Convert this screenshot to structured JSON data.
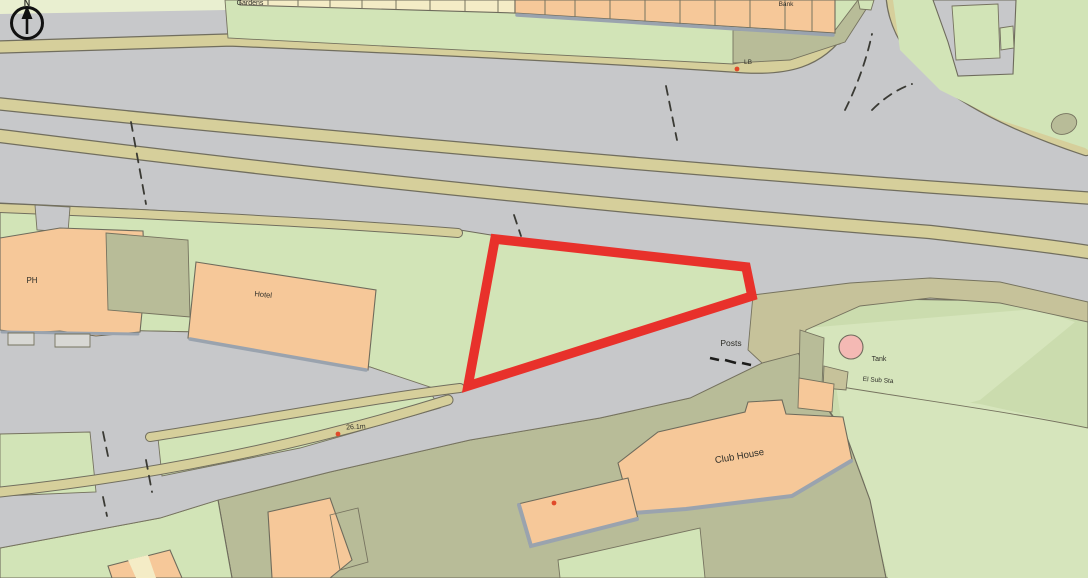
{
  "map": {
    "title": "Ordnance Survey style location plan with site outlined in red",
    "labels": {
      "north": "N",
      "gardens_partial": "Gardens",
      "bank_partial": "Bank",
      "lb": "LB",
      "ph": "PH",
      "hotel": "Hotel",
      "spot_height": "26.1m",
      "posts": "Posts",
      "tank": "Tank",
      "el_sub_sta": "El Sub Sta",
      "club_house": "Club House"
    },
    "colors": {
      "road_grey": "#c7c8ca",
      "verge_green": "#d2e4b7",
      "golf_green": "#cbdcae",
      "bright_green": "#d6e5bc",
      "path_tan": "#d6cf9b",
      "khaki_verge": "#c6c29a",
      "olive_green": "#b8bc98",
      "building_orange": "#f6c899",
      "building_cream": "#f4ecc6",
      "pale_strip": "#e9efd0",
      "tank_pink": "#f4b9b4",
      "site_boundary_red": "#e8312b",
      "outline_dark": "#6e6b5c",
      "shadow_grey": "#9aa3ae",
      "dot_red": "#e04a2a"
    }
  }
}
